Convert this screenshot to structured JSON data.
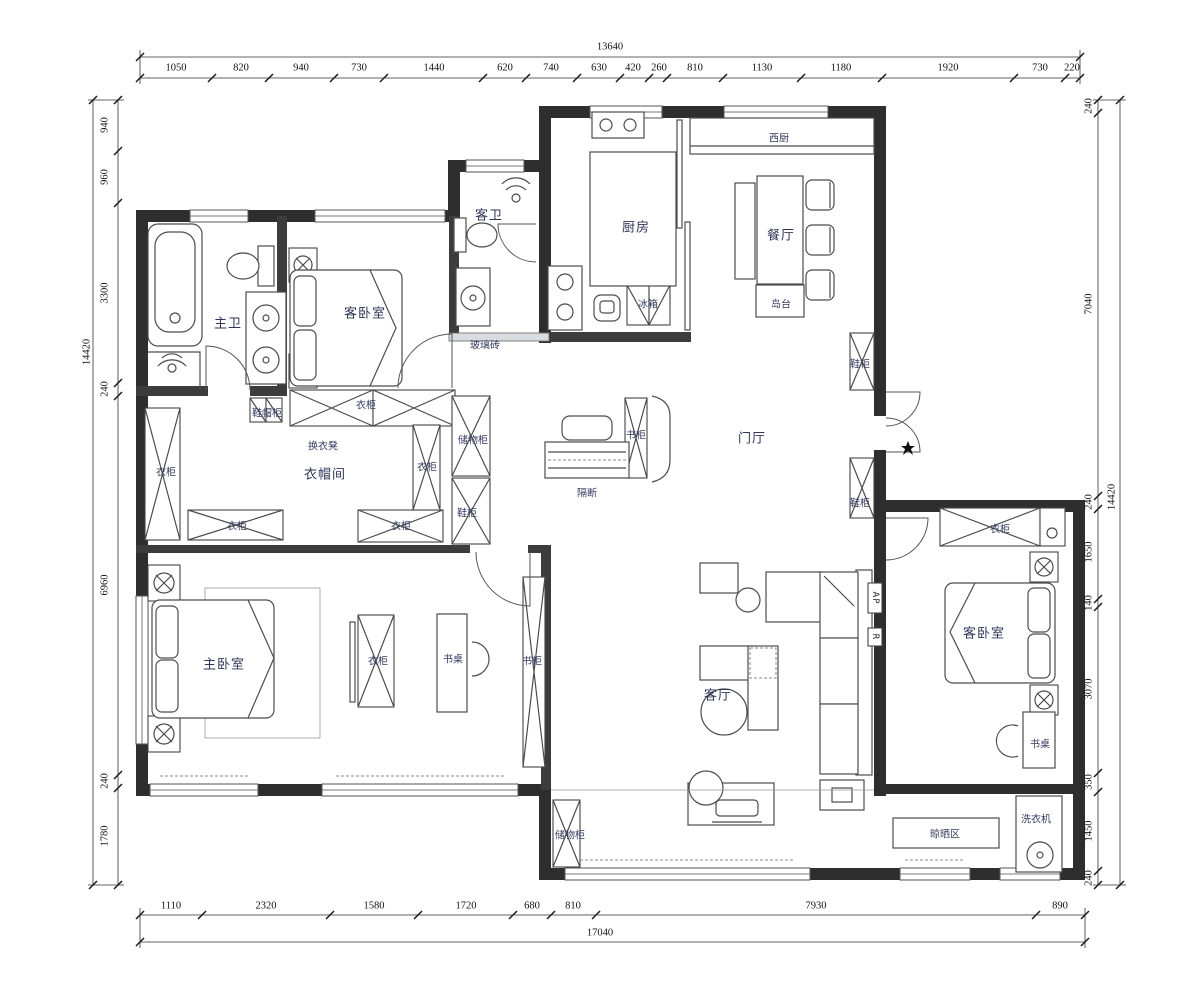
{
  "dims": {
    "top": {
      "total": "13640",
      "segments": [
        "1050",
        "820",
        "940",
        "730",
        "1440",
        "620",
        "740",
        "630",
        "420",
        "260",
        "810",
        "1130",
        "1180",
        "1920",
        "730",
        "220"
      ]
    },
    "bottom": {
      "total": "17040",
      "segments": [
        "1110",
        "2320",
        "1580",
        "1720",
        "680",
        "810",
        "7930",
        "890"
      ]
    },
    "left": {
      "total": "14420",
      "segments": [
        "940",
        "960",
        "3300",
        "240",
        "6960",
        "240",
        "1780"
      ]
    },
    "right": {
      "total": "14420",
      "segments": [
        "240",
        "7040",
        "240",
        "1650",
        "140",
        "3070",
        "350",
        "1450",
        "240"
      ]
    }
  },
  "rooms": {
    "master_bath": "主卫",
    "guest_bedroom_top": "客卧室",
    "guest_bath": "客卫",
    "kitchen": "厨房",
    "west_kitchen": "西厨",
    "dining": "餐厅",
    "cloakroom": "衣帽间",
    "foyer": "门厅",
    "master_bedroom": "主卧室",
    "living": "客厅",
    "guest_bedroom_right": "客卧室",
    "drying_area": "晾晒区"
  },
  "items": {
    "island": "岛台",
    "fridge": "冰箱",
    "glass_brick": "玻璃砖",
    "wardrobe": "衣柜",
    "hat_cabinet": "鞋帽柜",
    "changing_stool": "换衣凳",
    "storage_cabinet": "储物柜",
    "shoe_cabinet": "鞋柜",
    "partition": "隔断",
    "bookcase": "书柜",
    "desk": "书桌",
    "washer": "洗衣机"
  },
  "marks": {
    "ap": "AP",
    "r": "R"
  }
}
